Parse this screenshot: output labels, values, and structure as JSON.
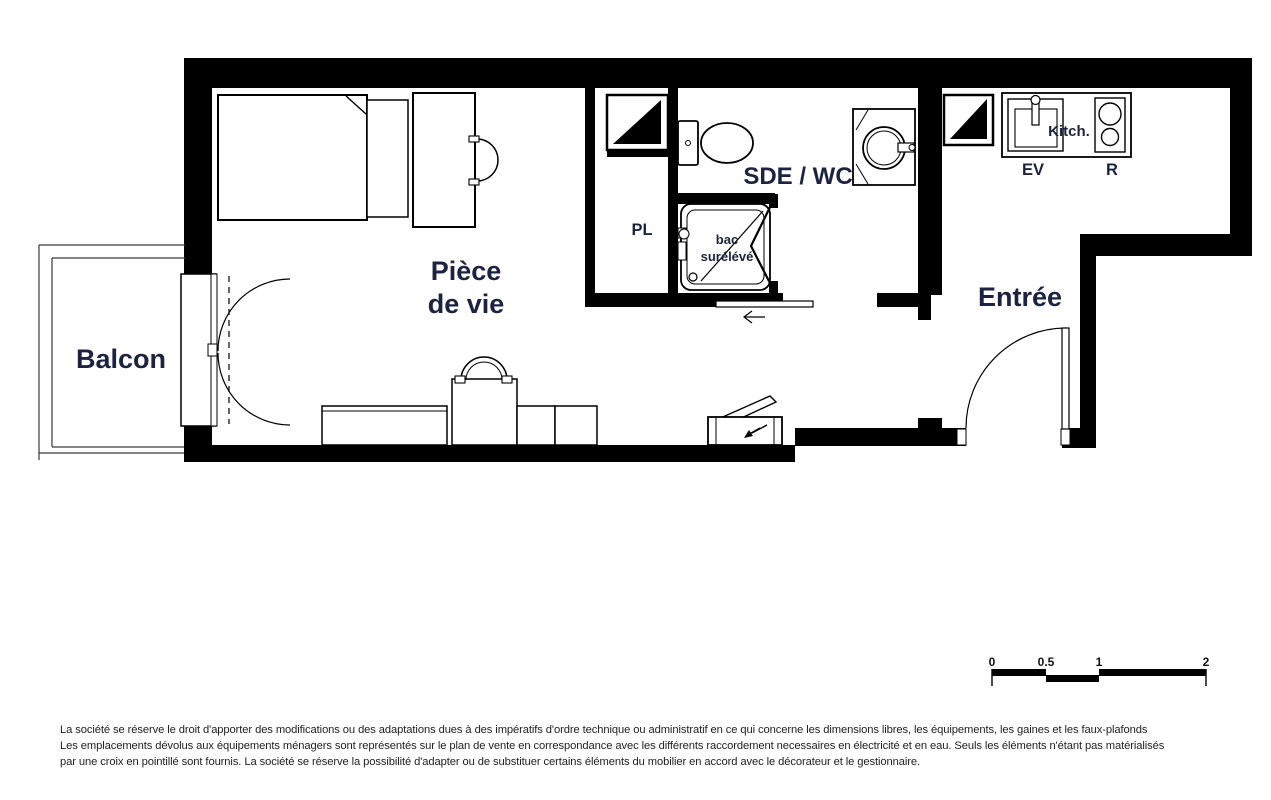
{
  "plan": {
    "labels": {
      "balcon": "Balcon",
      "piece_line1": "Pièce",
      "piece_line2": "de vie",
      "sde_wc": "SDE / WC",
      "pl": "PL",
      "entree": "Entrée",
      "kitch": "Kitch.",
      "ev": "EV",
      "r": "R",
      "bac_line1": "bac",
      "bac_line2": "surélévé"
    },
    "colors": {
      "wall": "#000000",
      "label": "#1b2340",
      "line": "#2b2b2b"
    },
    "scale_bar": {
      "tick0": "0",
      "tick05": "0.5",
      "tick1": "1",
      "tick2": "2"
    }
  },
  "disclaimer": {
    "line1": "La société se réserve le droit d'apporter des modifications ou des adaptations dues à des impératifs d'ordre technique ou administratif en ce qui concerne les dimensions libres, les équipements, les gaines et les faux-plafonds",
    "line2": "Les emplacements dévolus aux équipements ménagers sont représentés sur le plan de vente en correspondance avec les différents raccordement necessaires en électricité et en eau. Seuls les éléments n'étant pas matérialisés",
    "line3": "par une croix en pointillé sont fournis. La société se réserve la possibilité d'adapter ou de substituer certains éléments du mobilier en accord avec le décorateur et le gestionnaire."
  }
}
